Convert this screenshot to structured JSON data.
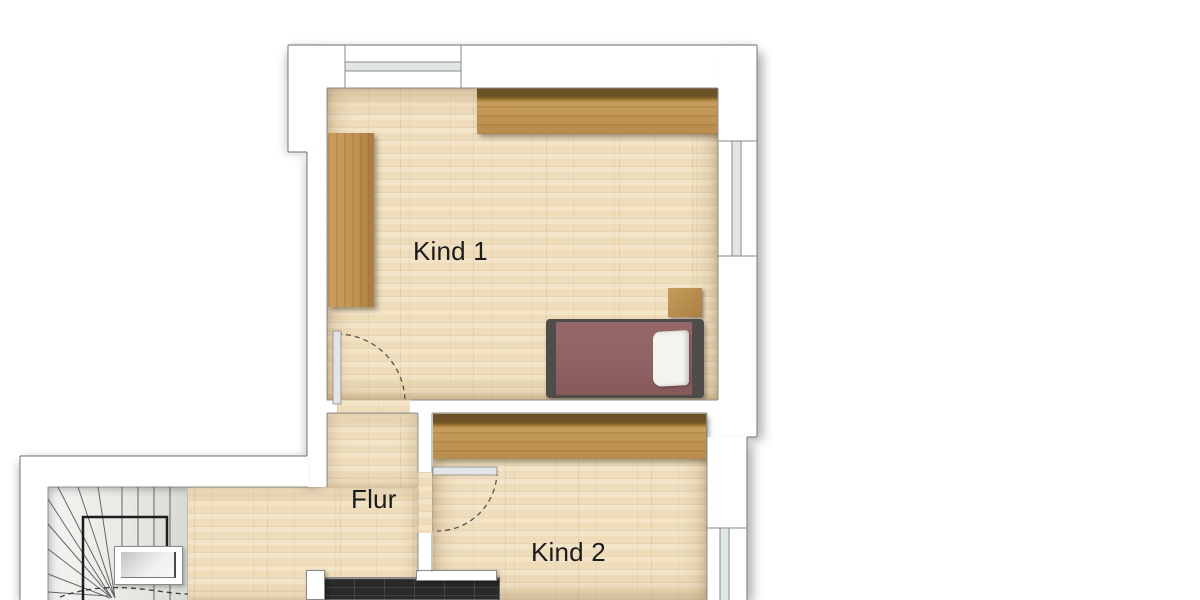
{
  "plan": {
    "type": "floor-plan",
    "rooms": [
      {
        "id": "kind1",
        "label": "Kind 1"
      },
      {
        "id": "flur",
        "label": "Flur"
      },
      {
        "id": "kind2",
        "label": "Kind 2"
      }
    ],
    "features": [
      "winder-staircase",
      "chimney-shaft",
      "bed-with-pillow",
      "wardrobes",
      "nightstand",
      "three-windows",
      "two-door-swings",
      "dark-tiled-fixture"
    ]
  },
  "colors": {
    "floor_wood": "#eedcba",
    "wardrobe_wood": "#c49a58",
    "wardrobe_shadow": "#6d5127",
    "bed_frame": "#4f4c49",
    "bed_blanket": "#8f6364",
    "pillow": "#f5f3ee",
    "stair_tread": "#ececea",
    "railing": "#1d1d1d",
    "wall_fill": "#ffffff",
    "wall_outline": "#8a8a8a",
    "window_glass": "#dfe6e3",
    "dark_fixture": "#2a2a2a",
    "label_text": "#1b1b1b"
  }
}
